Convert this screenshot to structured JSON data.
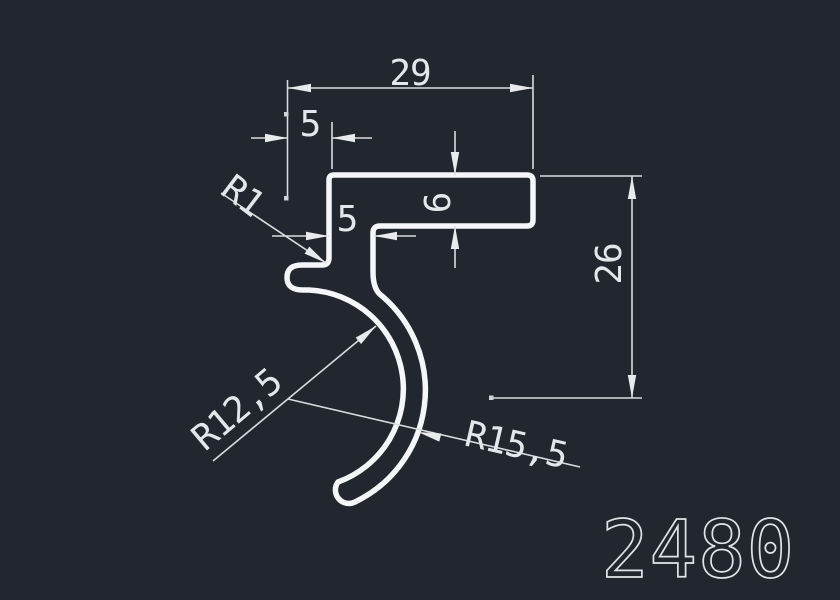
{
  "drawing": {
    "profile_number": "2480",
    "colors": {
      "background": "#22262e",
      "profile_line": "#f5f6f7",
      "dimension_line": "#d9dcdf",
      "text": "#e4e7ea"
    },
    "dimensions": {
      "overall_width": "29",
      "top_offset": "5",
      "flange_thickness": "6",
      "leg_offset": "5",
      "overall_height": "26",
      "corner_radius": "R1",
      "inner_radius": "R12,5",
      "outer_radius": "R15,5"
    }
  }
}
